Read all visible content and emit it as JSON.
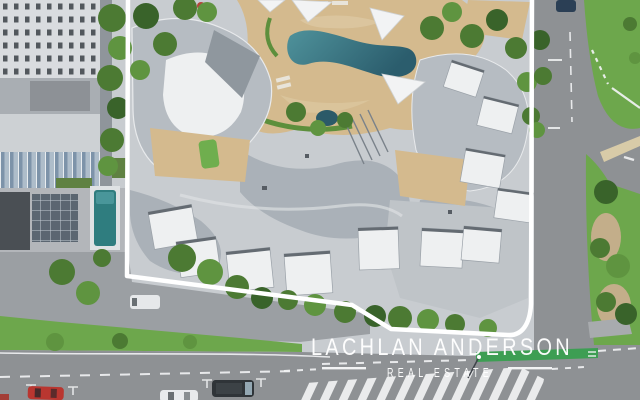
{
  "watermark": {
    "title": "LACHLAN ANDERSON",
    "subtitle": "REAL ESTATE"
  },
  "scene": {
    "type": "aerial-drone-photograph",
    "subject": "beachside apartment resort complex outlined with a white property boundary",
    "features": [
      "property-boundary-outline",
      "resort-pool",
      "shade-sails",
      "curved-rooftops",
      "adjacent-highrise",
      "lap-pool",
      "street-intersection",
      "grass-median",
      "pedestrian-crossing",
      "green-bike-lane",
      "parked-cars"
    ]
  },
  "colors": {
    "asphalt": "#8e9194",
    "asphalt_light": "#9b9fa3",
    "concrete": "#c8ccd0",
    "grass": "#6da74c",
    "lawn": "#7fae5a",
    "tree": "#4c7a33",
    "tree_light": "#5f9440",
    "tree_dark": "#39632a",
    "paving": "#d4ba8e",
    "paving_light": "#e0cda8",
    "mulch": "#c3ae8a",
    "roof_mid": "#aab1b8",
    "roof_mid2": "#b6bcc2",
    "roof_dark": "#8f979e",
    "roof_white": "#eef0f1",
    "facade": "#d9dcdf",
    "hedge": "#5d8f3c",
    "road_mark": "#f2f3f4",
    "bike_lane": "#3d9e53",
    "boundary": "#ffffff",
    "watermark": "#ffffff",
    "pool_light": "#4f929b",
    "pool_dark": "#2b5d6d",
    "car_red": "#b93630",
    "car_white": "#e8eaec",
    "car_dark": "#2f3438",
    "car_blue": "#2b3f55",
    "van_white": "#e6e8ea"
  },
  "vehicles": [
    {
      "name": "red-car-parked"
    },
    {
      "name": "white-car-parked"
    },
    {
      "name": "dark-van-parked"
    },
    {
      "name": "white-van-kerbside"
    },
    {
      "name": "blue-car-on-road"
    }
  ]
}
